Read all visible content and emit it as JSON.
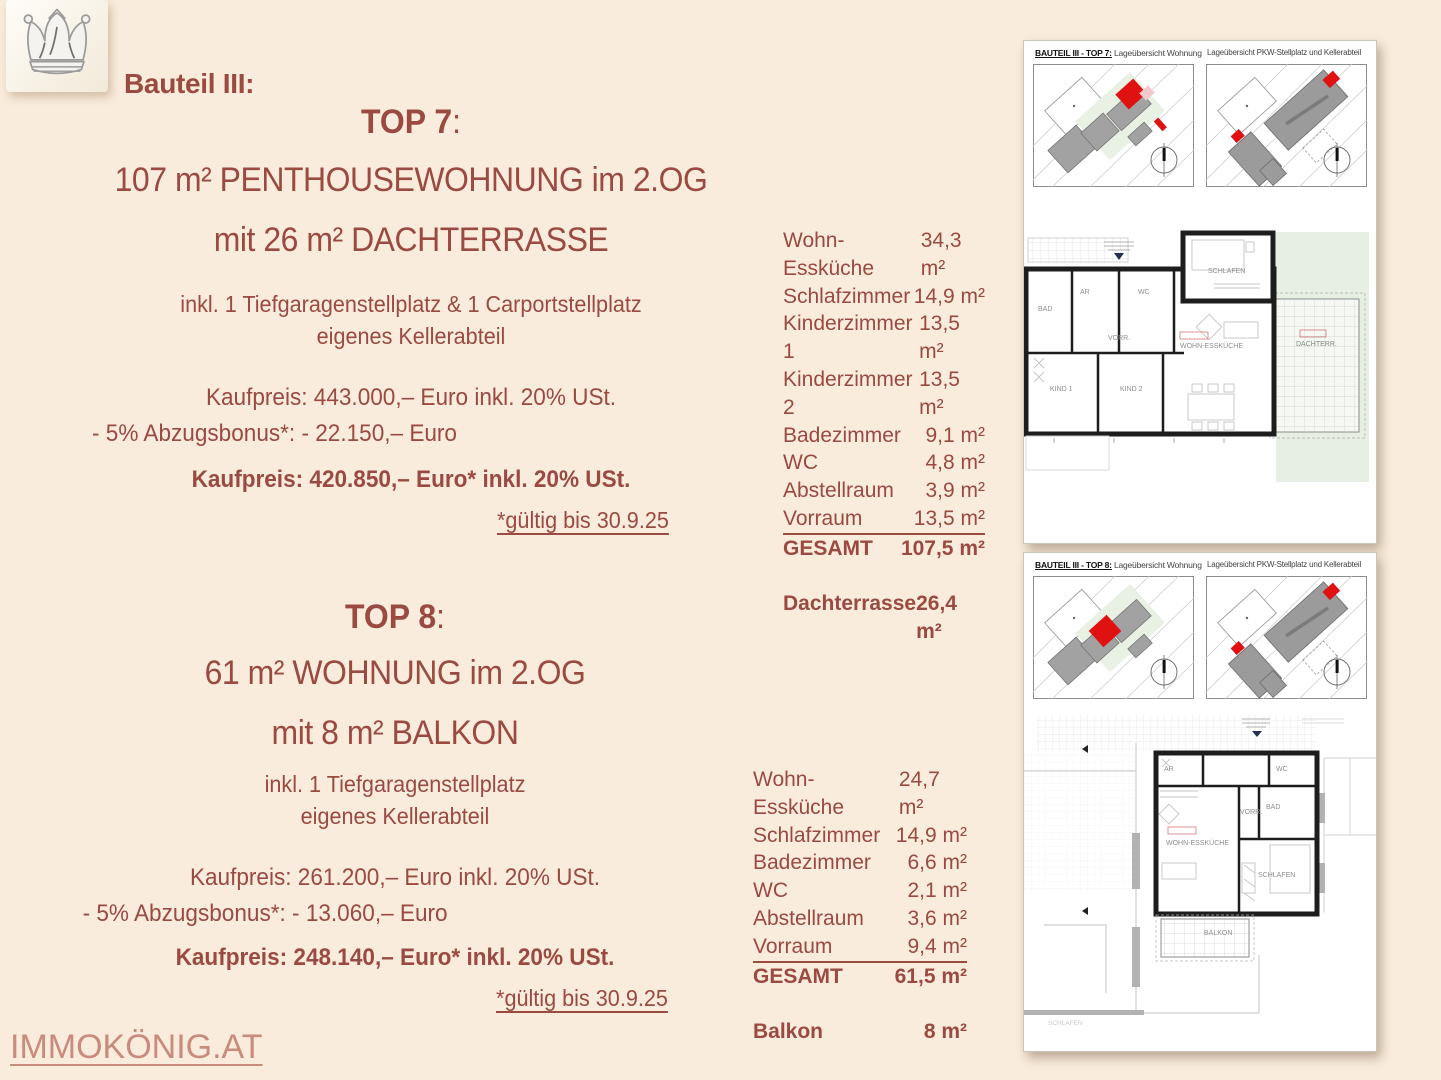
{
  "colors": {
    "background": "#f9ecdc",
    "text_primary": "#9a4a40",
    "brand_link": "#c98b7c",
    "highlight_red": "#e01111",
    "map_green": "#e9f1e5",
    "panel_bg": "#ffffff"
  },
  "icons": {
    "logo": "crown-icon",
    "compass": "compass-icon"
  },
  "header": {
    "section_label": "Bauteil III:"
  },
  "footer": {
    "brand": "IMMOKÖNIG.AT"
  },
  "top7": {
    "title": "TOP 7",
    "title_colon": ":",
    "headline1": "107 m² PENTHOUSEWOHNUNG im 2.OG",
    "headline2": "mit 26 m² DACHTERRASSE",
    "includes1": "inkl. 1 Tiefgaragenstellplatz & 1 Carportstellplatz",
    "includes2": "eigenes Kellerabteil",
    "price_gross": "Kaufpreis: 443.000,– Euro inkl. 20% USt.",
    "discount": "- 5% Abzugsbonus*: - 22.150,– Euro",
    "price_final": "Kaufpreis: 420.850,– Euro* inkl. 20% USt.",
    "valid_until": "*gültig bis 30.9.25",
    "rooms": [
      {
        "label": "Wohn-Essküche",
        "area": "34,3 m²"
      },
      {
        "label": "Schlafzimmer",
        "area": "14,9 m²"
      },
      {
        "label": "Kinderzimmer 1",
        "area": "13,5 m²"
      },
      {
        "label": "Kinderzimmer 2",
        "area": "13,5 m²"
      },
      {
        "label": "Badezimmer",
        "area": "9,1 m²"
      },
      {
        "label": "WC",
        "area": "4,8 m²"
      },
      {
        "label": "Abstellraum",
        "area": "3,9 m²"
      },
      {
        "label": "Vorraum",
        "area": "13,5 m²"
      }
    ],
    "total": {
      "label": "GESAMT",
      "area": "107,5 m²"
    },
    "extra": {
      "label": "Dachterrasse",
      "area": "26,4 m²"
    }
  },
  "top8": {
    "title": "TOP 8",
    "title_colon": ":",
    "headline1": "61 m² WOHNUNG im 2.OG",
    "headline2": "mit 8 m² BALKON",
    "includes1": "inkl. 1 Tiefgaragenstellplatz",
    "includes2": "eigenes Kellerabteil",
    "price_gross": "Kaufpreis: 261.200,– Euro inkl. 20% USt.",
    "discount": "- 5% Abzugsbonus*: - 13.060,– Euro",
    "price_final": "Kaufpreis: 248.140,– Euro* inkl. 20% USt.",
    "valid_until": "*gültig bis 30.9.25",
    "rooms": [
      {
        "label": "Wohn-Essküche",
        "area": "24,7 m²"
      },
      {
        "label": "Schlafzimmer",
        "area": "14,9 m²"
      },
      {
        "label": "Badezimmer",
        "area": "6,6 m²"
      },
      {
        "label": "WC",
        "area": "2,1 m²"
      },
      {
        "label": "Abstellraum",
        "area": "3,6 m²"
      },
      {
        "label": "Vorraum",
        "area": "9,4 m²"
      }
    ],
    "total": {
      "label": "GESAMT",
      "area": "61,5 m²"
    },
    "extra": {
      "label": "Balkon",
      "area": "8 m²"
    }
  },
  "panel_top7": {
    "title_bold": "BAUTEIL III - TOP 7:",
    "title_text": "Lageübersicht Wohnung",
    "title_right": "Lageübersicht PKW-Stellplatz und Kellerabteil",
    "plan_rooms": {
      "schlafen": "SCHLAFEN",
      "bad": "BAD",
      "ar": "AR",
      "wc": "WC",
      "vorraum": "VORR.",
      "kind1": "KIND 1",
      "kind2": "KIND 2",
      "wohn": "WOHN-ESSKÜCHE",
      "terrasse": "DACHTERR."
    }
  },
  "panel_top8": {
    "title_bold": "BAUTEIL III - TOP 8:",
    "title_text": "Lageübersicht Wohnung",
    "title_right": "Lageübersicht PKW-Stellplatz und Kellerabteil",
    "plan_rooms": {
      "ar": "AR",
      "wc": "WC",
      "bad": "BAD",
      "vorraum": "VORR.",
      "wohn": "WOHN-ESSKÜCHE",
      "schlafen": "SCHLAFEN",
      "balkon": "BALKON",
      "neighbor": "SCHLAFEN"
    }
  }
}
